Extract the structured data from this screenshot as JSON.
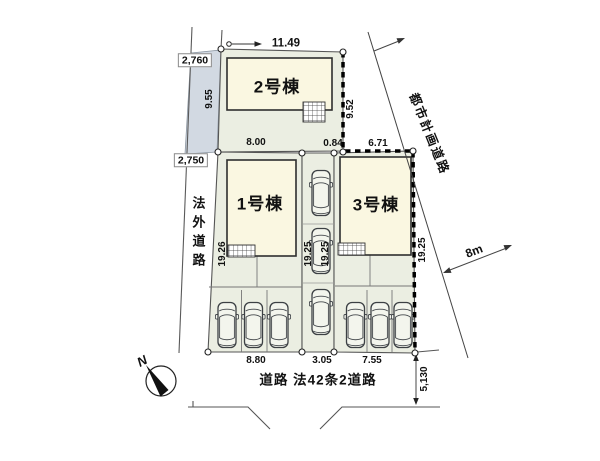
{
  "plan": {
    "buildings": {
      "b1": "1号棟",
      "b2": "2号棟",
      "b3": "3号棟"
    },
    "roads": {
      "left_road": "法外道路",
      "planned_road": "都市計画道路",
      "planned_road_width": "8m",
      "bottom_road": "道路 法42条2道路"
    },
    "compass": {
      "north": "N"
    },
    "dims": {
      "lot2_width_top": "11.49",
      "left_road_width_top": "2,760",
      "lot2_left_length": "9.55",
      "left_road_width_mid": "2,750",
      "lot2_right_length": "9.52",
      "lot1_width_top": "8.00",
      "lot3_top_seg_a": "0.84",
      "lot3_top_seg_b": "6.71",
      "lot1_left_length": "19.26",
      "drive_left_length": "19.25",
      "drive_right_length": "19.25",
      "lot3_right_length": "19.25",
      "lot1_width_bottom": "8.80",
      "drive_width_bottom": "3.05",
      "lot3_width_bottom": "7.55",
      "bottom_road_width": "5,130"
    },
    "colors": {
      "lot": "#ebeee2",
      "building": "#faf7e1",
      "setback_strip": "#d2d9e2",
      "line": "#4a4a4a"
    }
  }
}
